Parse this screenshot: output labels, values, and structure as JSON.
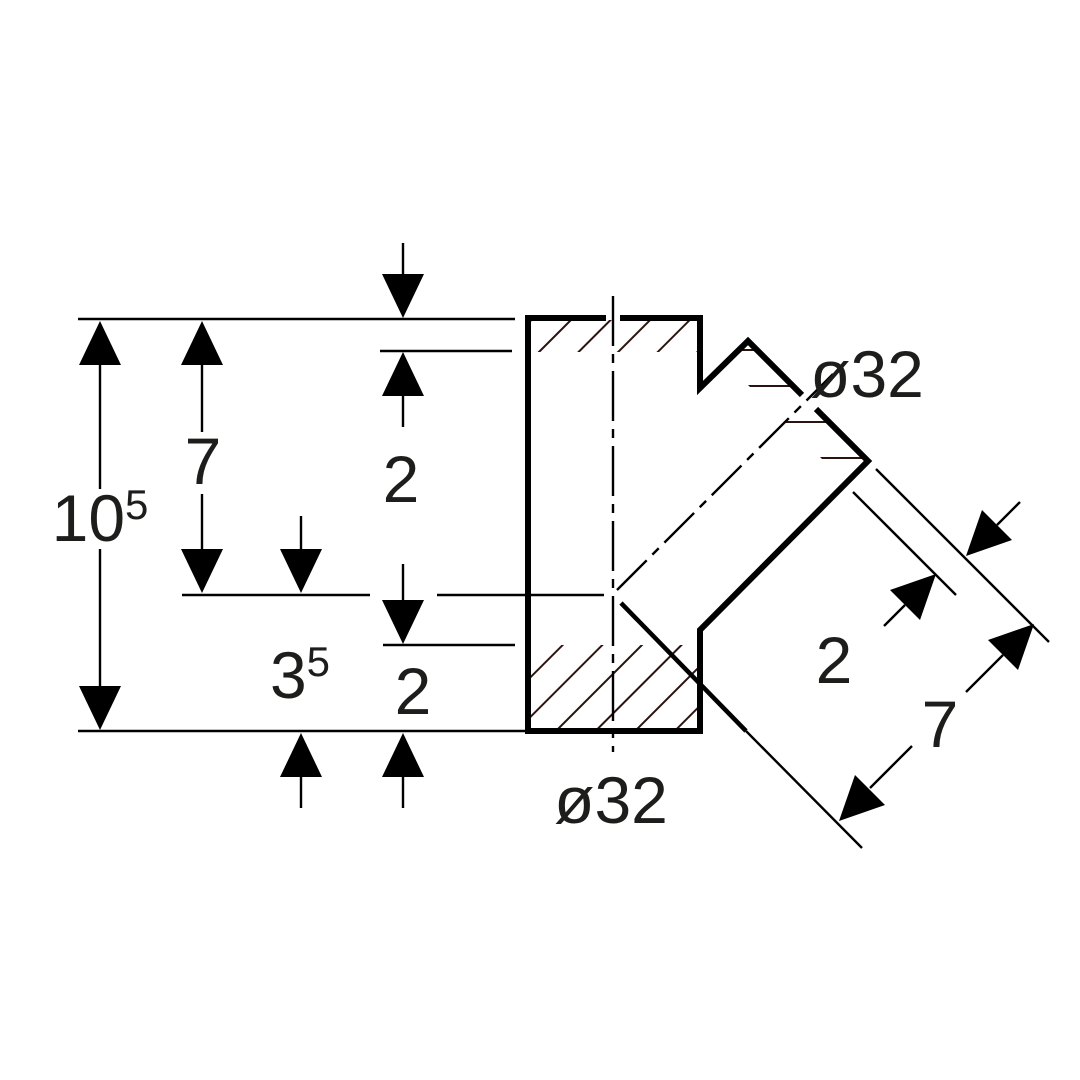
{
  "drawing": {
    "type": "technical-section",
    "part": "45-degree branch fitting",
    "labels": {
      "dim_overall_height": {
        "base": "10",
        "sup": "5"
      },
      "dim_top_to_junction": "7",
      "dim_top_wall": "2",
      "dim_bottom_section": {
        "base": "3",
        "sup": "5"
      },
      "dim_bottom_wall": "2",
      "dia_main": "ø32",
      "dia_branch": "ø32",
      "dim_branch_wall": "2",
      "dim_branch_depth": "7"
    },
    "colors": {
      "line": "#000000",
      "text": "#1d1d1b",
      "hatch": "#2b1410",
      "background": "#ffffff"
    }
  }
}
